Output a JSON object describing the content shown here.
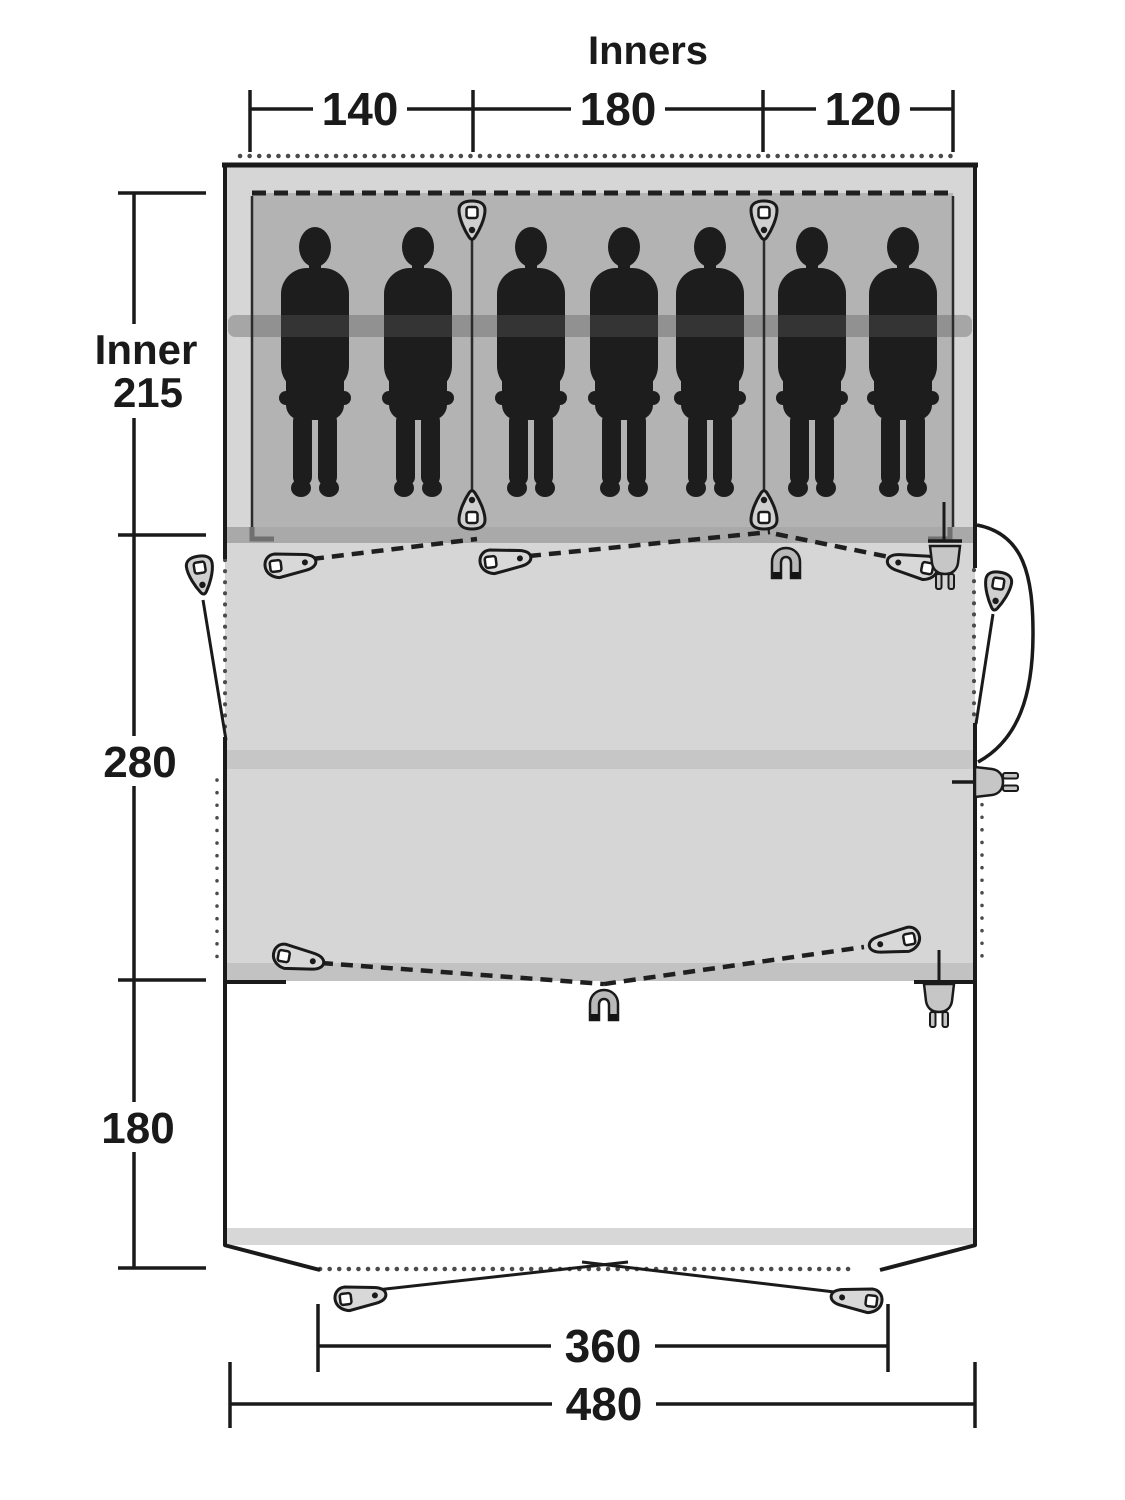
{
  "diagram": {
    "title": "Inners",
    "top_dimension": {
      "values": [
        "140",
        "180",
        "120"
      ]
    },
    "left_dimension": {
      "inner_label": "Inner",
      "inner_depth": "215",
      "living_depth": "280",
      "porch_depth": "180"
    },
    "bottom_dimension": {
      "front_width": "360",
      "total_width": "480"
    },
    "sleeping": {
      "count": 7,
      "positions_x": [
        315,
        418,
        531,
        624,
        710,
        812,
        903
      ]
    },
    "colors": {
      "outline": "#1a1a1a",
      "tent_fill": "#d6d6d6",
      "inner_fill": "#b3b3b3",
      "sleeve_band": "#a9a9a9",
      "mid_band": "#c6c6c6",
      "lower_band": "#c2c2c2",
      "porch_band": "#d7d7d7",
      "silhouette": "#1d1d1d"
    },
    "icons": [
      "zipper-pull-icon",
      "magnet-icon",
      "power-plug-icon"
    ]
  }
}
